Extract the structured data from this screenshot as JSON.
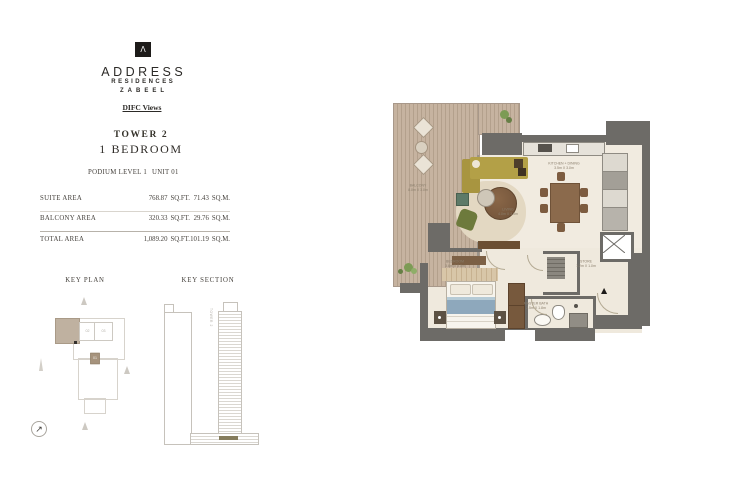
{
  "brand": {
    "logo_glyph": "Λ",
    "name": "ADDRESS",
    "line2": "RESIDENCES",
    "line3": "ZABEEL",
    "tagline": "DIFC Views"
  },
  "unit": {
    "tower": "TOWER 2",
    "type": "1 BEDROOM",
    "level": "PODIUM LEVEL 1",
    "number": "UNIT 01"
  },
  "area_table": {
    "rows": [
      {
        "label": "SUITE AREA",
        "sqft": "768.87",
        "sqft_unit": "SQ.FT.",
        "sqm": "71.43",
        "sqm_unit": "SQ.M."
      },
      {
        "label": "BALCONY AREA",
        "sqft": "320.33",
        "sqft_unit": "SQ.FT.",
        "sqm": "29.76",
        "sqm_unit": "SQ.M."
      },
      {
        "label": "TOTAL AREA",
        "sqft": "1,089.20",
        "sqft_unit": "SQ.FT.",
        "sqm": "101.19",
        "sqm_unit": "SQ.M."
      }
    ]
  },
  "key_plan": {
    "title": "KEY PLAN",
    "unit_labels": [
      "01",
      "02",
      "03"
    ],
    "highlighted_unit": "01"
  },
  "key_section": {
    "title": "KEY SECTION",
    "tower_label": "TOWER 2"
  },
  "floor_plan": {
    "entry_marker": "▲",
    "compass_glyph": "↗",
    "rooms": [
      {
        "name": "BALCONY",
        "dims": "8.0m X 3.0m"
      },
      {
        "name": "LIVING",
        "dims": "4.0m X 3.5m"
      },
      {
        "name": "KITCHEN + DINING",
        "dims": "3.5m X 3.0m"
      },
      {
        "name": "BEDROOM",
        "dims": "3.6m X 3.0m"
      },
      {
        "name": "MASTER BATH",
        "dims": "2.5m X 1.8m"
      },
      {
        "name": "STORE",
        "dims": "1.2m X 1.0m"
      }
    ]
  },
  "colors": {
    "wall": "#6d6b67",
    "deck": "#c6b3a0",
    "floor": "#f1ebe0",
    "section_highlight": "#857c5c",
    "key_plan_unit": "#a6937d",
    "sofa": "#b3a047"
  }
}
